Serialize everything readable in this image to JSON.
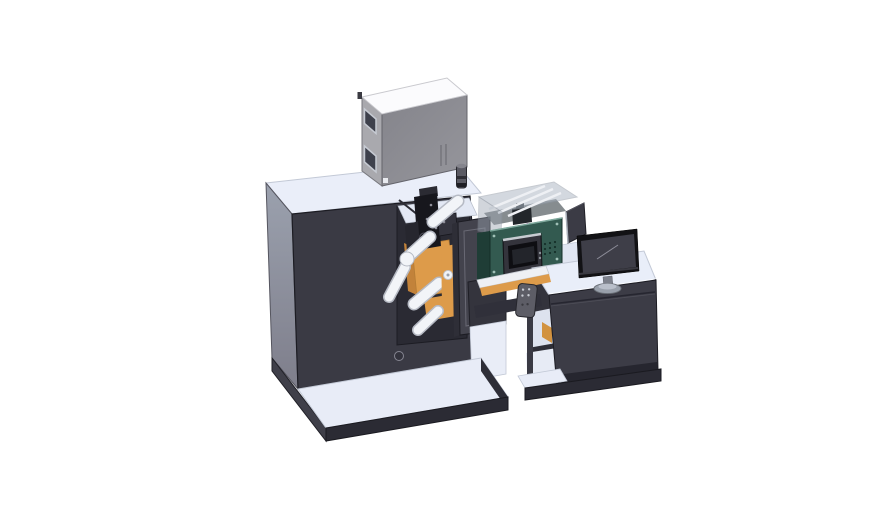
{
  "colors": {
    "background": "#ffffff",
    "surface_light": "#eaeef9",
    "surface_light2": "#e3e8f4",
    "edge_light": "#c3c9d6",
    "body_dark": "#3a3a44",
    "body_dark_lighter": "#43434d",
    "body_darker": "#2d2d36",
    "recess_dark": "#2a2a33",
    "outline_dark": "#1c1c23",
    "side_gray_top": "#9ba1ae",
    "side_gray_bottom": "#7e7e8b",
    "cabinet_top": "#fbfbfd",
    "cabinet_side": "#a9a9ae",
    "cabinet_front": "#8e8e94",
    "window_dark": "#3e414c",
    "window_frame": "#c6cad2",
    "cylinder_gray": "#5a5a63",
    "orange": "#dd9b4a",
    "orange_dark": "#c2823a",
    "roller_white": "#f2f4f8",
    "roller_stroke": "#b6bac4",
    "mech_black": "#17171d",
    "mech_gray": "#34343e",
    "teal_front": "#335a50",
    "teal_side": "#1f3d36",
    "teal_highlight": "#7fa99d",
    "screen_bezel": "#0e0e12",
    "screen_gray": "#23252b",
    "glass_fill": "#a8b2c0",
    "glass_stroke": "#8f97a3",
    "rail_white": "#eef0f4",
    "magenta": "#c253c9",
    "monitor_bezel": "#121215",
    "monitor_screen": "#3e3e48",
    "stand_gray": "#99a0ab",
    "remote_gray": "#5d5d66",
    "platform_edge": "#2b2b34",
    "platform_top": "#e8ecf7",
    "desk_front": "#3c3c46",
    "desk_top": "#e9eef9",
    "shelf_white": "#e7ebf5"
  }
}
